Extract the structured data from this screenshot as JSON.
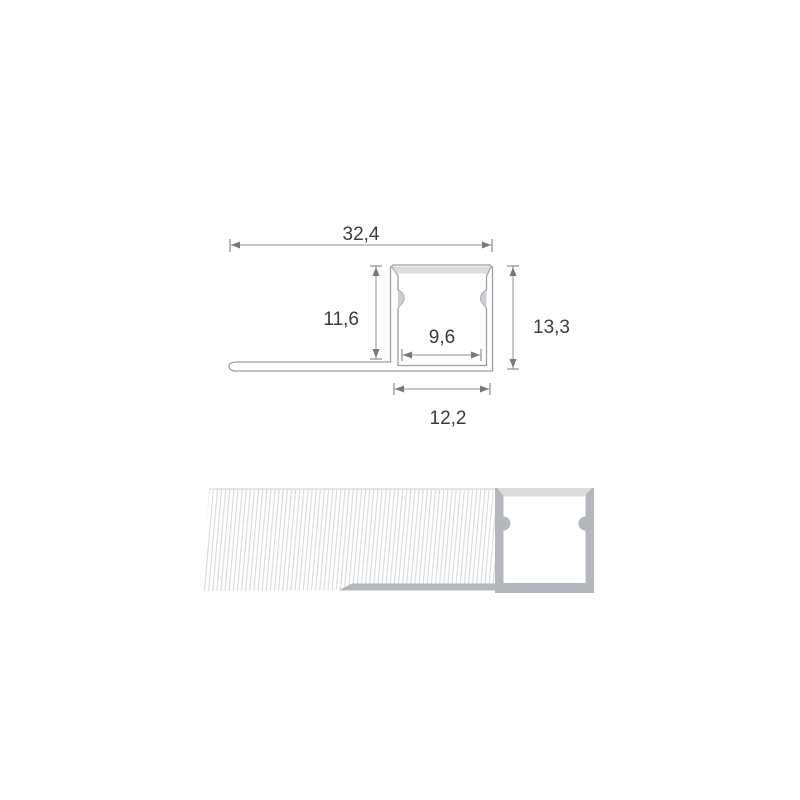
{
  "diagram": {
    "kind": "led-tile-trim-profile-cross-section",
    "dimensions": {
      "overall_width": "32,4",
      "channel_inner_height": "11,6",
      "inner_seat_width": "9,6",
      "overall_height": "13,3",
      "channel_outer_width": "12,2"
    },
    "colors": {
      "background": "#ffffff",
      "outline_gray": "#9aa0a6",
      "dimension_gray": "#8d9196",
      "text_gray": "#3b3b3b",
      "profile_fill_gray": "#b4b8bc",
      "diffuser_light_gray": "#dadcde",
      "notch_gray": "#caced1",
      "hatch_line_gray": "#d5d7da"
    }
  }
}
